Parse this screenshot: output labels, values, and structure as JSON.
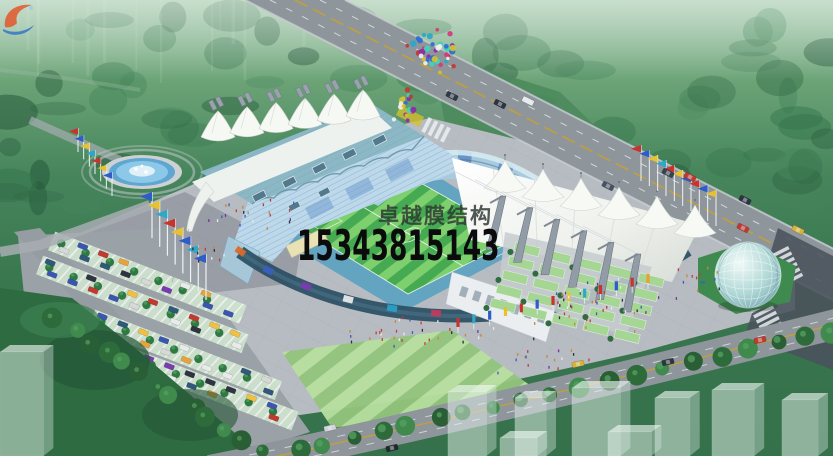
{
  "image": {
    "kind": "architectural rendering",
    "subject": "aerial rendering of a stadium with white tensile membrane roofs, blue grandstands, striped football pitch, plaza with fountain and flags, parking lots, glass dome pavilion, roads and translucent concept buildings",
    "width": 833,
    "height": 456
  },
  "watermark": {
    "logo_icon": "membrane-swoosh-logo",
    "brand": "卓越膜结构",
    "phone": "15343815143",
    "brand_color": "#2c342f",
    "phone_color": "#0b0b0b",
    "logo_colors": [
      "#e2572b",
      "#2b72c8",
      "#8fd0e8"
    ]
  },
  "palette": {
    "forest_green": "#3d7c52",
    "forest_dark": "#2c6342",
    "haze_green": "#9cc3ab",
    "road_gray": "#8e969c",
    "road_dark": "#4a545e",
    "lane_yellow": "#c8a030",
    "plaza_gray": "#b7bcc2",
    "pitch_light": "#7ed06e",
    "pitch_dark": "#46aa52",
    "track_teal": "#4e9ec0",
    "seat_blue": "#bcd8ea",
    "seat_deep": "#5a86c2",
    "roof_teal": "#8cb8c6",
    "membrane_white": "#f4f6f2",
    "mast_gray": "#929ca6",
    "steps_green": "#a6d694",
    "bush_green": "#2e6d3d",
    "water_blue": "#5fa6d0",
    "glass_dome": "#bfe0dc",
    "ghost_white": "#e6f2ec",
    "facade_teal": "#2a4e62"
  },
  "decor": {
    "balloon_count": 58,
    "balloon_colors": [
      "#2e6bd6",
      "#d63a7a",
      "#8a2ea8",
      "#28a8c8",
      "#d6c12e",
      "#c03a30",
      "#3ad6b8",
      "#f0f0f0"
    ],
    "flag_colors": [
      "#c8332e",
      "#2e5cc8",
      "#e8c22e",
      "#2ea8c8",
      "#c8332e",
      "#e8c22e",
      "#2e5cc8"
    ],
    "banner_colors": [
      "#c8332e",
      "#2ea8c8",
      "#2e5cc8",
      "#e8c22e",
      "#c8332e",
      "#2e5cc8",
      "#c8332e",
      "#e8c22e",
      "#2ea8c8",
      "#c8332e",
      "#2e5cc8",
      "#c8332e",
      "#e8a02e"
    ],
    "car_colors": [
      "#e8eaec",
      "#c03a30",
      "#e8a23c",
      "#3a56b0",
      "#7a3ab0",
      "#2e3440",
      "#f0c040",
      "#d8d8d8",
      "#30587a"
    ],
    "people_colors": [
      "#c23b3b",
      "#3b5cc2",
      "#2e2e38",
      "#e8e8e8",
      "#c28a3b",
      "#7a2ea0"
    ],
    "ad_colors": [
      "#d86a2a",
      "#3a5ec0",
      "#7a3ab0",
      "#e8e8e8",
      "#2aa0c8",
      "#c03a60"
    ]
  }
}
